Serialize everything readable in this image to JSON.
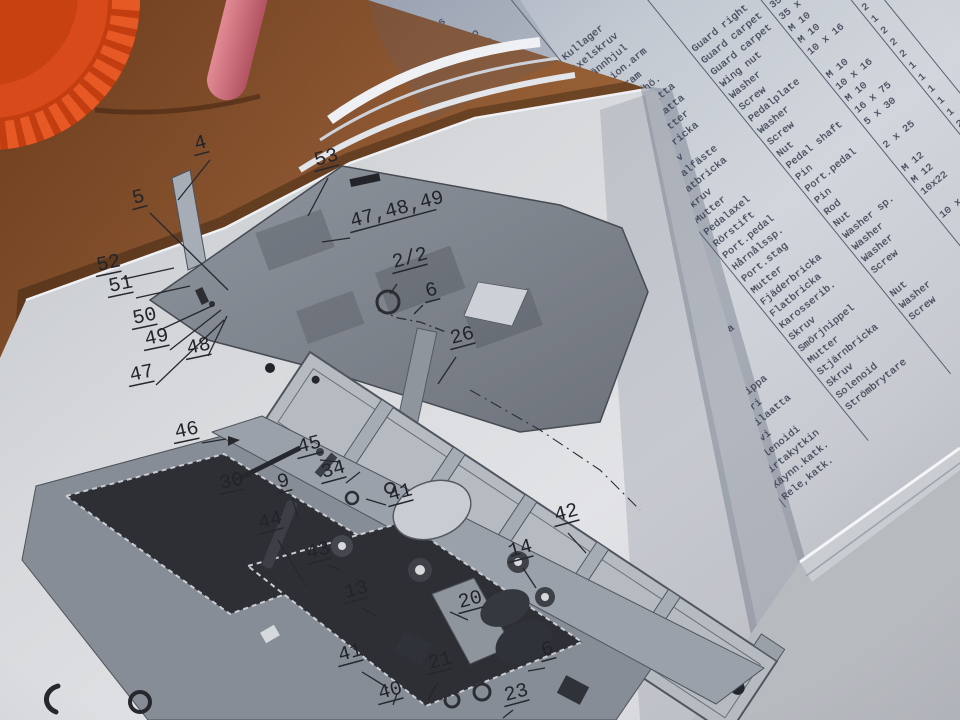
{
  "colors": {
    "wood": "#8a5530",
    "lid_orange": "#d84a1a",
    "pen_pink": "#c9677a",
    "page_gray": "#d2d6dc",
    "typewriter_ink": "#3a3e50",
    "diagram_ink": "#26282e"
  },
  "parts_table": {
    "headers": {
      "item": [
        "Osa",
        "Del",
        "Item"
      ],
      "part_no": [
        "Tilaus.nr",
        "Best.nr",
        "Part No."
      ]
    },
    "rows": [
      {
        "item": "2/2",
        "part": "340401",
        "fi": "Rengas",
        "sv": "",
        "en": "",
        "dim": "",
        "qty": ""
      },
      {
        "item": "3",
        "part": "512002",
        "fi": "Hela",
        "sv": "",
        "en": "",
        "dim": "",
        "qty": ""
      },
      {
        "item": "4",
        "part": "221401",
        "fi": "Pikalukko",
        "sv": "",
        "en": "",
        "dim": "",
        "qty": ""
      },
      {
        "item": "5",
        "part": "292090",
        "fi": "Rasvanippa",
        "sv": "",
        "en": "",
        "dim": "",
        "qty": ""
      },
      {
        "item": "6",
        "part": "390020",
        "fi": "Hela",
        "sv": "",
        "en": "",
        "dim": "",
        "qty": ""
      },
      {
        "item": "7",
        "part": "531002",
        "fi": "Pinnapultti",
        "sv": "",
        "en": "",
        "dim": "",
        "qty": ""
      },
      {
        "item": "8",
        "part": "291005",
        "fi": "Lukkorengas",
        "sv": "",
        "en": "",
        "dim": "",
        "qty": ""
      },
      {
        "item": "9",
        "part": "290405",
        "fi": "Kuulalaakeri",
        "sv": "Kullager",
        "en": "",
        "dim": "",
        "qty": "2"
      },
      {
        "item": "10",
        "part": "502007",
        "fi": "Aks.ruuvi",
        "sv": "Axelskruv",
        "en": "",
        "dim": "",
        "qty": "1"
      },
      {
        "item": "11",
        "part": "519001",
        "fi": "Kir.pyörä",
        "sv": "Spännhjul",
        "en": "",
        "dim": "",
        "qty": "1"
      },
      {
        "item": "12",
        "part": "660011",
        "fi": "Annos.varsi",
        "sv": "Portion.arm",
        "en": "",
        "dim": "",
        "qty": "1"
      },
      {
        "item": "13",
        "part": "667004",
        "fi": "Runko",
        "sv": "Grundram",
        "en": "",
        "dim": "",
        "qty": "1"
      },
      {
        "item": "14",
        "part": "650005",
        "fi": "Suoja oik.",
        "sv": "Skydd, hö.",
        "en": "Guard right",
        "dim": "",
        "qty": "1"
      },
      {
        "item": "15/a",
        "part": "575002",
        "fi": "Suojamatto",
        "sv": "Skyddsmatta",
        "en": "Guard carpet",
        "dim": "35 x 12",
        "qty": "1"
      },
      {
        "item": "15/b",
        "part": "575001",
        "fi": "Suojamatto",
        "sv": "Skyddsmatta",
        "en": "Guard carpet",
        "dim": "35 x 12",
        "qty": "1"
      },
      {
        "item": "16",
        "part": "100874",
        "fi": "Siipimutteri",
        "sv": "Vingmutter",
        "en": "Wing nut",
        "dim": "M 10",
        "qty": "2"
      },
      {
        "item": "17",
        "part": "160008",
        "fi": "Laatta",
        "sv": "Platbricka",
        "en": "Washer",
        "dim": "M 10",
        "qty": "2"
      },
      {
        "item": "18",
        "part": "101006",
        "fi": "Ruuvi",
        "sv": "Skruv",
        "en": "Screw",
        "dim": "10 x 16",
        "qty": "2"
      },
      {
        "item": "19",
        "part": "660012",
        "fi": "Poljinkiin.",
        "sv": "Pedalfäste",
        "en": "Pedalplate",
        "dim": "",
        "qty": "1"
      },
      {
        "item": "20",
        "part": "160010",
        "fi": "Laatta",
        "sv": "Flatbricka",
        "en": "Washer",
        "dim": "M 10",
        "qty": "2"
      },
      {
        "item": "21",
        "part": "101021",
        "fi": "Ruuvi",
        "sv": "Skruv",
        "en": "Screw",
        "dim": "10 x 16",
        "qty": "2"
      },
      {
        "item": "22",
        "part": "660014",
        "fi": "Mutteri",
        "sv": "Mutter",
        "en": "Nut",
        "dim": "M 10",
        "qty": "2"
      },
      {
        "item": "23",
        "part": "183517",
        "fi": "Akseli",
        "sv": "Pedalaxel",
        "en": "Pedal shaft",
        "dim": "16 x 75",
        "qty": "1"
      },
      {
        "item": "24",
        "part": "660013",
        "fi": "Putk.sokka",
        "sv": "Rörstift",
        "en": "Pin",
        "dim": "5 x 30",
        "qty": "1"
      },
      {
        "item": "25",
        "part": "181501",
        "fi": "Ann.poljin",
        "sv": "Port.pedal",
        "en": "Port.pedal",
        "dim": "",
        "qty": "1"
      },
      {
        "item": "26",
        "part": "501057",
        "fi": "Hiusn.sokka",
        "sv": "Hårnålssp.",
        "en": "Pin",
        "dim": "2 x 25",
        "qty": "1"
      },
      {
        "item": "27",
        "part": "101221",
        "fi": "Varsi",
        "sv": "Port.stag",
        "en": "Rod",
        "dim": "",
        "qty": "1"
      },
      {
        "item": "28",
        "part": "162012",
        "fi": "Mutteri",
        "sv": "Mutter",
        "en": "Nut",
        "dim": "M 12",
        "qty": "2"
      },
      {
        "item": "29",
        "part": "160012",
        "fi": "Jousilaatta",
        "sv": "Fjäderbricka",
        "en": "Washer sp.",
        "dim": "M 12",
        "qty": "2"
      },
      {
        "item": "30",
        "part": "160808",
        "fi": "Laatta",
        "sv": "Flatbricka",
        "en": "Washer",
        "dim": "10x22",
        "qty": "2"
      },
      {
        "item": "34",
        "part": "101007",
        "fi": "Laatta",
        "sv": "Karosserib.",
        "en": "Washer",
        "dim": "",
        "qty": "2"
      },
      {
        "item": "40",
        "part": "101002",
        "fi": "Ruuvi",
        "sv": "Skruv",
        "en": "Screw",
        "dim": "10 x 16",
        "qty": "2"
      },
      {
        "item": "45",
        "part": "292095",
        "fi": "Rasvanippa",
        "sv": "Smörjnippel",
        "en": "",
        "dim": "",
        "qty": "1"
      },
      {
        "item": "46",
        "part": "1006X1",
        "fi": "Mutteri",
        "sv": "Mutter",
        "en": "Nut",
        "dim": "",
        "qty": "1"
      },
      {
        "item": "47",
        "part": "162306",
        "fi": "Tähtilaatta",
        "sv": "Stjärnbricka",
        "en": "Washer",
        "dim": "M 12",
        "qty": "1"
      },
      {
        "item": "48",
        "part": "100602",
        "fi": "Ruuvi",
        "sv": "Skruv",
        "en": "Screw",
        "dim": "",
        "qty": "1"
      },
      {
        "item": "50",
        "part": "370160",
        "fi": "Solenoidi",
        "sv": "Solenoid",
        "en": "",
        "dim": "",
        "qty": "1"
      },
      {
        "item": "52",
        "part": "343102",
        "fi": "Virtakytkin",
        "sv": "Strömbrytare",
        "en": "",
        "dim": "",
        "qty": "1"
      },
      {
        "item": "53",
        "part": "343001",
        "fi": "Käynn.katk.",
        "sv": "",
        "en": "",
        "dim": "",
        "qty": "1"
      },
      {
        "item": "",
        "part": "",
        "fi": "Rele,katk.",
        "sv": "",
        "en": "",
        "dim": "109-13",
        "qty": ""
      }
    ]
  },
  "diagram": {
    "callouts": [
      {
        "label": "4",
        "x": 196,
        "y": 150,
        "line": [
          210,
          160,
          178,
          200
        ]
      },
      {
        "label": "53",
        "x": 316,
        "y": 166,
        "line": [
          328,
          178,
          308,
          216
        ]
      },
      {
        "label": "5",
        "x": 134,
        "y": 204,
        "line": [
          150,
          213,
          228,
          290
        ]
      },
      {
        "label": "52",
        "x": 98,
        "y": 271,
        "line": [
          124,
          279,
          174,
          268
        ],
        "rot": -12
      },
      {
        "label": "51",
        "x": 110,
        "y": 292,
        "line": [
          136,
          298,
          190,
          286
        ],
        "rot": -12
      },
      {
        "label": "50",
        "x": 134,
        "y": 324,
        "line": [
          160,
          330,
          214,
          305
        ],
        "rot": -12
      },
      {
        "label": "49",
        "x": 146,
        "y": 345,
        "line": [
          170,
          350,
          221,
          310
        ],
        "rot": -12
      },
      {
        "label": "48",
        "x": 188,
        "y": 354,
        "line": [
          208,
          356,
          227,
          316
        ],
        "rot": -12
      },
      {
        "label": "47",
        "x": 131,
        "y": 381,
        "line": [
          156,
          385,
          224,
          320
        ],
        "rot": -12
      },
      {
        "label": "47,48,49",
        "x": 352,
        "y": 227,
        "line": [
          350,
          238,
          322,
          242
        ]
      },
      {
        "label": "2/2",
        "x": 394,
        "y": 268,
        "line": [
          397,
          284,
          390,
          294
        ]
      },
      {
        "label": "6",
        "x": 427,
        "y": 297,
        "line": [
          423,
          305,
          414,
          314
        ]
      },
      {
        "label": "26",
        "x": 452,
        "y": 344,
        "line": [
          456,
          357,
          438,
          384
        ]
      },
      {
        "label": "46",
        "x": 176,
        "y": 438,
        "line": [
          202,
          443,
          226,
          439
        ],
        "rot": -12
      },
      {
        "label": "30",
        "x": 221,
        "y": 489,
        "rot": -12
      },
      {
        "label": "45",
        "x": 299,
        "y": 453,
        "line": [
          320,
          460,
          340,
          462
        ]
      },
      {
        "label": "34",
        "x": 323,
        "y": 478,
        "line": [
          346,
          483,
          360,
          472
        ]
      },
      {
        "label": "9",
        "x": 279,
        "y": 488,
        "line": [
          292,
          497,
          298,
          518
        ]
      },
      {
        "label": "41",
        "x": 390,
        "y": 501,
        "line": [
          386,
          505,
          366,
          499
        ]
      },
      {
        "label": "44",
        "x": 260,
        "y": 529,
        "line": [
          278,
          540,
          306,
          586
        ]
      },
      {
        "label": "43",
        "x": 308,
        "y": 559,
        "line": [
          328,
          565,
          340,
          570
        ]
      },
      {
        "label": "42",
        "x": 556,
        "y": 521,
        "line": [
          568,
          533,
          586,
          553
        ]
      },
      {
        "label": "14",
        "x": 510,
        "y": 557,
        "line": [
          523,
          568,
          536,
          588
        ]
      },
      {
        "label": "13",
        "x": 346,
        "y": 598,
        "line": [
          362,
          608,
          376,
          616
        ]
      },
      {
        "label": "20",
        "x": 460,
        "y": 608,
        "line": [
          468,
          620,
          450,
          612
        ]
      },
      {
        "label": "41",
        "x": 340,
        "y": 661,
        "line": [
          362,
          672,
          388,
          688
        ]
      },
      {
        "label": "40",
        "x": 380,
        "y": 699,
        "line": [
          393,
          705,
          397,
          694
        ]
      },
      {
        "label": "21",
        "x": 430,
        "y": 669,
        "line": [
          438,
          682,
          428,
          700
        ]
      },
      {
        "label": "23",
        "x": 506,
        "y": 701,
        "line": [
          513,
          710,
          503,
          718
        ]
      },
      {
        "label": "6",
        "x": 543,
        "y": 656,
        "line": [
          545,
          668,
          528,
          671
        ]
      }
    ]
  }
}
